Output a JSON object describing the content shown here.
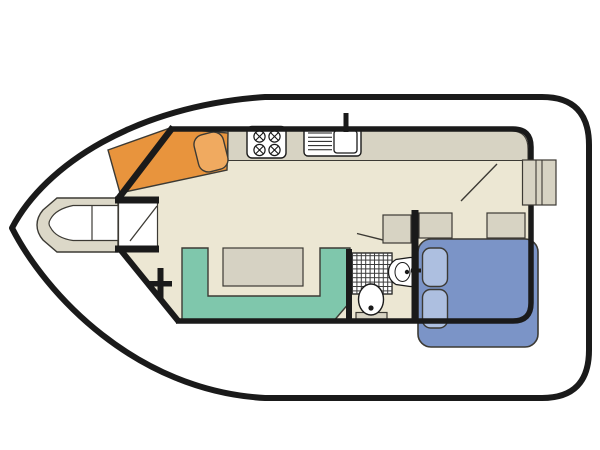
{
  "title": "Houseboat deck floor plan",
  "canvas": {
    "width": 600,
    "height": 450,
    "background": "#ffffff"
  },
  "colors": {
    "outline": "#1a1a1a",
    "thin_stroke": "#3c3a34",
    "hull_fill": "#ffffff",
    "floor": "#ece7d3",
    "counter": "#d7d3c3",
    "cabinet": "#d7d3c3",
    "table": "#d6d2c3",
    "helm_console": "#e8943d",
    "helm_seat": "#f0aa60",
    "dinette": "#7fc7ac",
    "bed": "#7b94c7",
    "pillow": "#adbfe0",
    "bow_locker": "#dcd8c8",
    "white": "#ffffff",
    "hatch": "#3a3a3a"
  },
  "legend": {
    "features": [
      "pointed bow hull",
      "bow locker with v-seat",
      "entry companionway with door swing",
      "helm console with swivel seat",
      "galley counter",
      "4-burner stove",
      "sink with drainer and tap",
      "U-shaped dinette bench",
      "dinette table",
      "shower tray",
      "toilet",
      "corner washbasin",
      "storage cabinets",
      "double bed with two pillows",
      "side-deck steps",
      "cabin door swing",
      "boat cleat"
    ]
  }
}
